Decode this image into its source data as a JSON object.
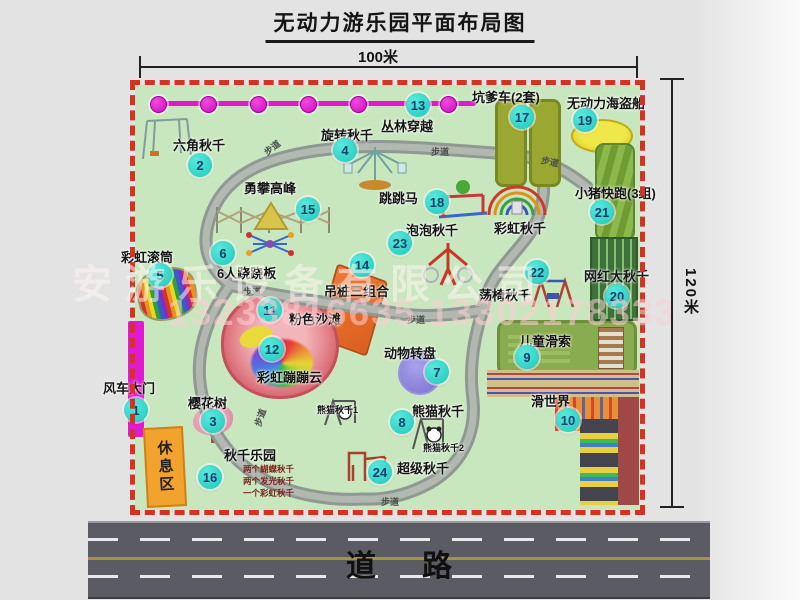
{
  "title": "无动力游乐园平面布局图",
  "dimensions": {
    "width_label": "100米",
    "height_label": "120米"
  },
  "road": {
    "label": "道路"
  },
  "watermark": {
    "company": "安游乐设备有限公司",
    "phone": "13233816635 13302178333"
  },
  "path_label": "步道",
  "attractions": [
    {
      "num": "1",
      "label": "风车大门"
    },
    {
      "num": "2",
      "label": "六角秋千"
    },
    {
      "num": "3",
      "label": "樱花树"
    },
    {
      "num": "4",
      "label": "旋转秋千"
    },
    {
      "num": "5",
      "label": "彩虹滚筒"
    },
    {
      "num": "6",
      "label": "6人跷跷板"
    },
    {
      "num": "7",
      "label": "动物转盘"
    },
    {
      "num": "8",
      "label": "熊猫秋千"
    },
    {
      "num": "9",
      "label": "儿童滑索"
    },
    {
      "num": "10",
      "label": "滑世界"
    },
    {
      "num": "11",
      "label": "粉色沙滩"
    },
    {
      "num": "12",
      "label": "彩虹蹦蹦云"
    },
    {
      "num": "13",
      "label": "丛林穿越"
    },
    {
      "num": "14",
      "label": "吊桩三组合"
    },
    {
      "num": "15",
      "label": "勇攀高峰"
    },
    {
      "num": "16",
      "label": "秋千乐园"
    },
    {
      "num": "17",
      "label": "坑爹车(2套)"
    },
    {
      "num": "18",
      "label": "跳跳马"
    },
    {
      "num": "19",
      "label": "无动力海盗船"
    },
    {
      "num": "20",
      "label": "网红大秋千"
    },
    {
      "num": "21",
      "label": "小猪快跑(3组)"
    },
    {
      "num": "22",
      "label": "荡椅秋千"
    },
    {
      "num": "23",
      "label": "泡泡秋千"
    },
    {
      "num": "24",
      "label": "超级秋千"
    }
  ],
  "extras": {
    "rainbow_swing": "彩虹秋千",
    "rest_area": "休息区",
    "panda_swing_1": "熊猫秋千1",
    "panda_swing_2": "熊猫秋千2",
    "swing_park_notes": [
      "两个蝴蝶秋千",
      "两个发光秋千",
      "一个彩虹秋千"
    ]
  },
  "colors": {
    "park_green": "#c9e7bf",
    "fence_red": "#d53222",
    "badge_teal": "#2fd3c6",
    "gate_magenta": "#e318ce",
    "road_gray": "#5b5b64"
  }
}
